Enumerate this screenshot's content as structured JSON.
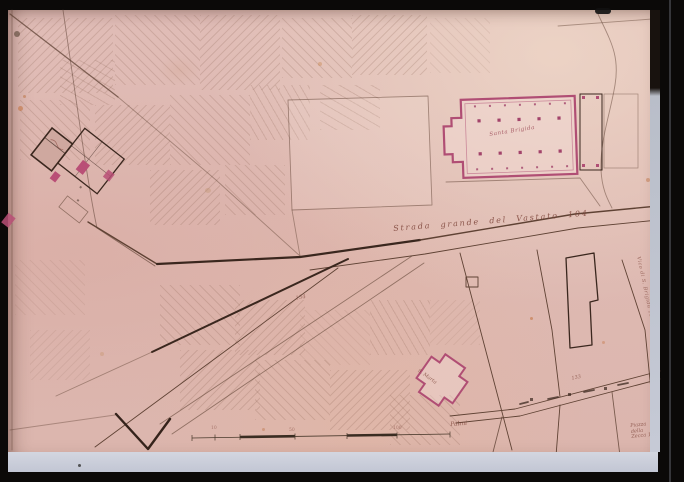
{
  "artifact": {
    "kind": "photographed slide of a hand-drawn historical city map",
    "colors": {
      "paper": "#debab4",
      "ink": "#4a3026",
      "church_pink": "#b04e74",
      "mount": "#c6cad6"
    }
  },
  "labels": {
    "street_main": "Strada grande del Vastato 104",
    "church_large": "Santa Brigida",
    "church_small": "S. Marta",
    "alley_right": "Vico di S. Brigida 105",
    "piazza_line1": "Piazza",
    "piazza_line2": "della",
    "piazza_line3": "Zecca 132",
    "parcel_number": "134",
    "street_number": "133",
    "scale_label": "Palmi",
    "scale_ticks": [
      "10",
      "50",
      "100"
    ]
  }
}
